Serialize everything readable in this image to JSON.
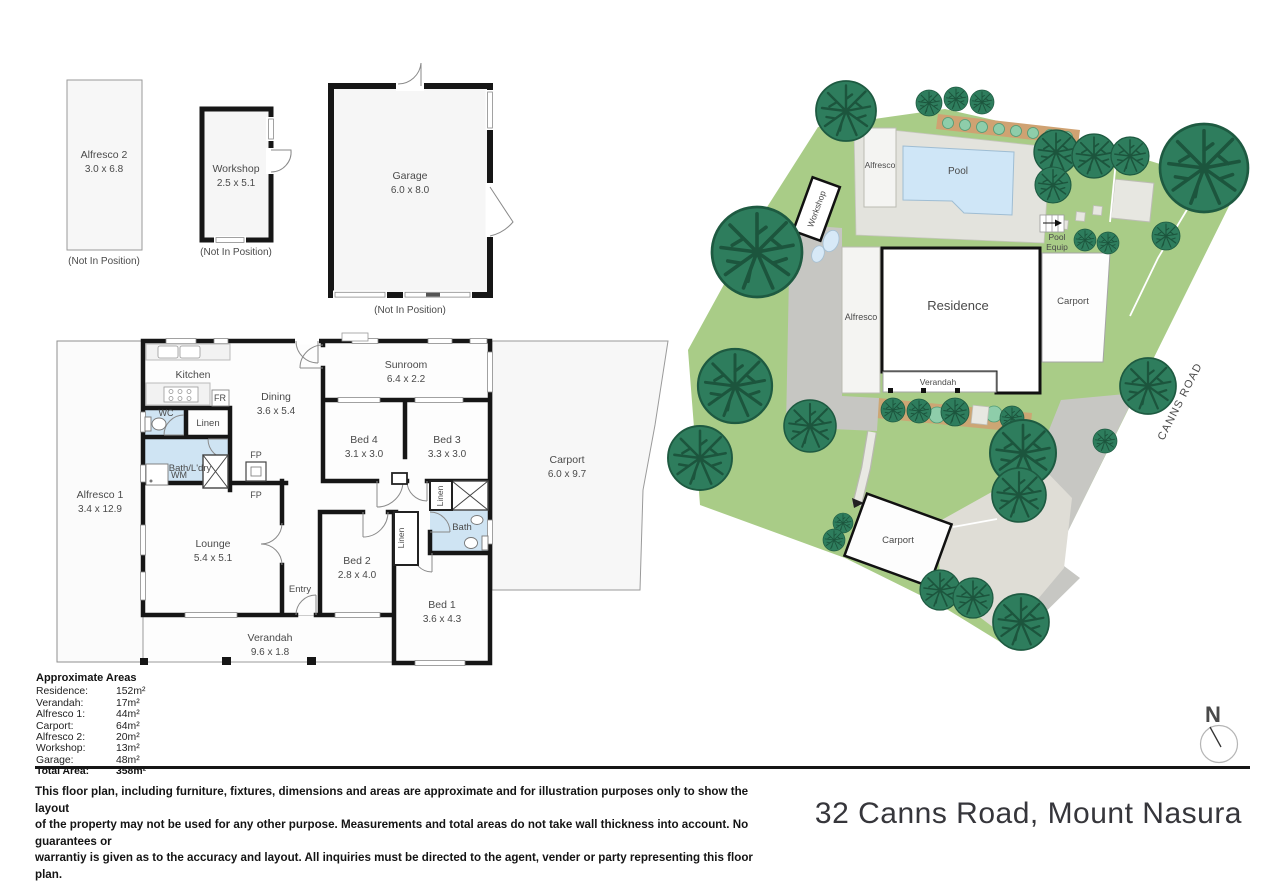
{
  "address": "32 Canns Road, Mount Nasura",
  "compass_n": "N",
  "road_label": "CANNS ROAD",
  "not_in_position": "(Not In Position)",
  "outbuildings": {
    "alfresco2": {
      "name": "Alfresco 2",
      "dims": "3.0 x 6.8"
    },
    "workshop": {
      "name": "Workshop",
      "dims": "2.5 x 5.1"
    },
    "garage": {
      "name": "Garage",
      "dims": "6.0 x 8.0"
    }
  },
  "floorplan": {
    "kitchen": "Kitchen",
    "fr": "FR",
    "wc": "WC",
    "linen": "Linen",
    "linen2": "Linen",
    "linen3": "Linen",
    "bath_ldry": "Bath/L'dry",
    "wm": "WM",
    "fp_top": "FP",
    "fp_bottom": "FP",
    "entry": "Entry",
    "bath": "Bath",
    "dining": {
      "name": "Dining",
      "dims": "3.6 x 5.4"
    },
    "sunroom": {
      "name": "Sunroom",
      "dims": "6.4 x 2.2"
    },
    "bed4": {
      "name": "Bed 4",
      "dims": "3.1 x 3.0"
    },
    "bed3": {
      "name": "Bed 3",
      "dims": "3.3 x 3.0"
    },
    "carport": {
      "name": "Carport",
      "dims": "6.0 x 9.7"
    },
    "alfresco1": {
      "name": "Alfresco 1",
      "dims": "3.4 x 12.9"
    },
    "lounge": {
      "name": "Lounge",
      "dims": "5.4 x 5.1"
    },
    "bed2": {
      "name": "Bed 2",
      "dims": "2.8 x 4.0"
    },
    "bed1": {
      "name": "Bed 1",
      "dims": "3.6 x 4.3"
    },
    "verandah": {
      "name": "Verandah",
      "dims": "9.6 x 1.8"
    }
  },
  "site": {
    "workshop": "Workshop",
    "alfresco_pool": "Alfresco",
    "pool": "Pool",
    "pool_equip_line1": "Pool",
    "pool_equip_line2": "Equip",
    "alfresco": "Alfresco",
    "residence": "Residence",
    "verandah": "Verandah",
    "carport_top": "Carport",
    "carport_bottom": "Carport"
  },
  "areas": {
    "title": "Approximate Areas",
    "rows": [
      {
        "label": "Residence:",
        "value": "152m²"
      },
      {
        "label": "Verandah:",
        "value": "17m²"
      },
      {
        "label": "Alfresco 1:",
        "value": "44m²"
      },
      {
        "label": "Carport:",
        "value": "64m²"
      },
      {
        "label": "Alfresco 2:",
        "value": "20m²"
      },
      {
        "label": "Workshop:",
        "value": "13m²"
      },
      {
        "label": "Garage:",
        "value": "48m²"
      }
    ],
    "total_label": "Total Area:",
    "total_value": "358m²"
  },
  "disclaimer": {
    "line1": "This floor plan, including furniture, fixtures, dimensions and areas are approximate and for illustration purposes only to show the layout",
    "line2": "of the property may not be used for any other purpose. Measurements and total areas do not take wall thickness into account. No guarantees or",
    "line3": "warrantiy is given as to the accuracy and layout. All inquiries must be directed to the agent, vender or party representing this floor plan."
  },
  "colors": {
    "grass": "#a9cc87",
    "tree": "#2e7d5d",
    "pool": "#cfe6f7",
    "wet_room": "#cfe4f3",
    "wall": "#161616",
    "driveway": "#c7c7c3",
    "concrete": "#e3e3dd"
  }
}
